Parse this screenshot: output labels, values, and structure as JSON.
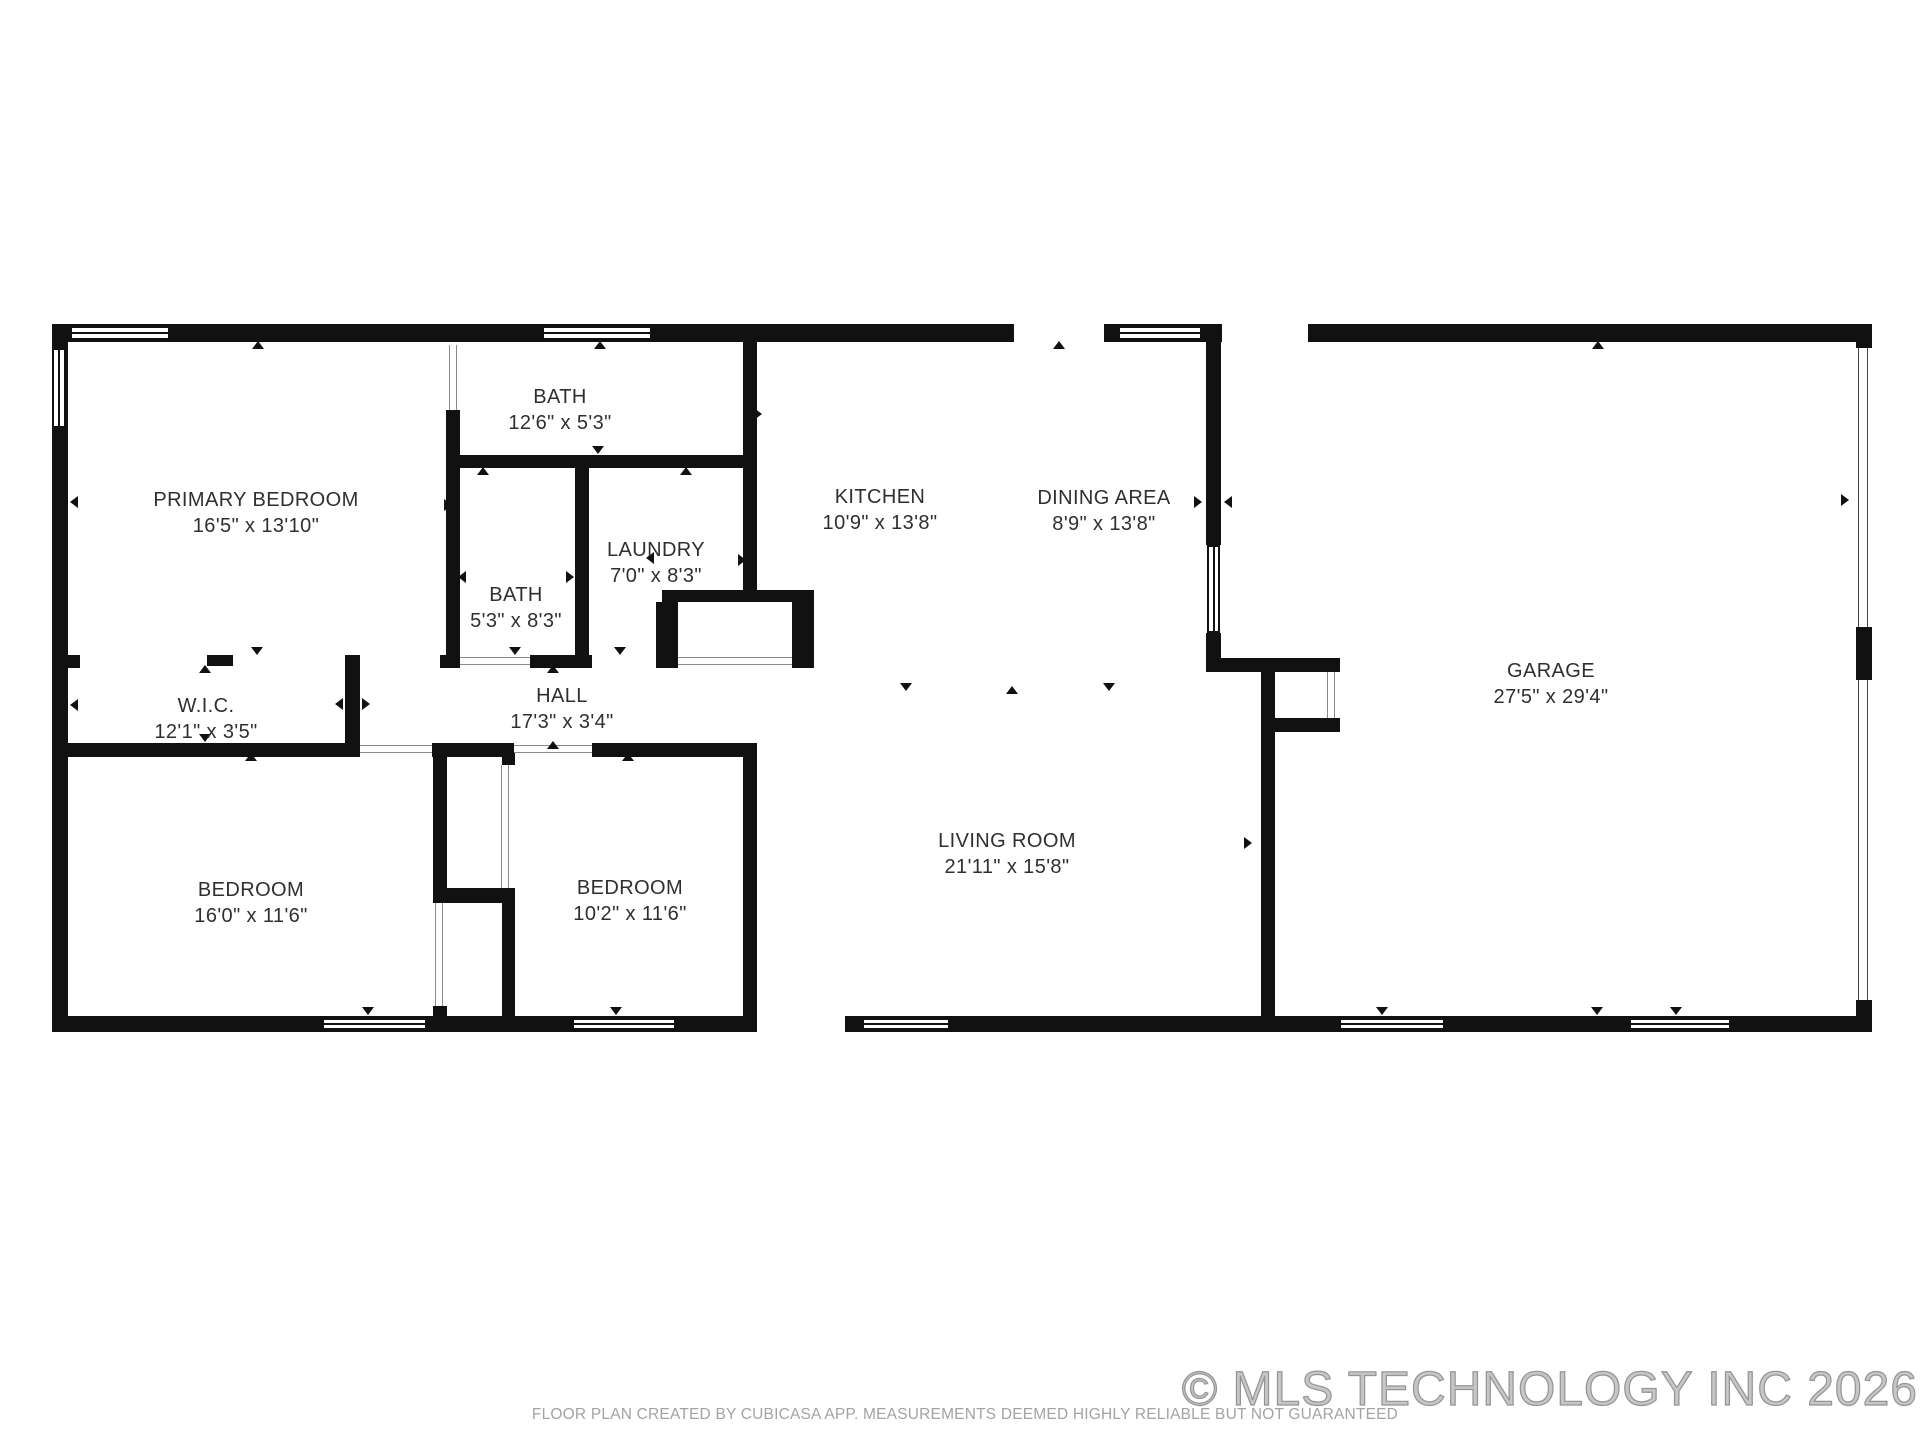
{
  "canvas": {
    "w": 1920,
    "h": 1440
  },
  "colors": {
    "wall": "#111111",
    "label": "#2f2f2f",
    "muted": "#a3a3a3",
    "watermark": "#9c9c9c"
  },
  "footer": {
    "disclaimer": "FLOOR PLAN CREATED BY CUBICASA APP. MEASUREMENTS DEEMED HIGHLY RELIABLE BUT NOT GUARANTEED",
    "copyright": "© MLS TECHNOLOGY INC 2026"
  },
  "rooms": [
    {
      "id": "primary-bedroom",
      "name": "PRIMARY BEDROOM",
      "dims": "16'5\" x 13'10\"",
      "cx": 256,
      "cy": 513
    },
    {
      "id": "bath-top",
      "name": "BATH",
      "dims": "12'6\" x 5'3\"",
      "cx": 560,
      "cy": 410
    },
    {
      "id": "kitchen",
      "name": "KITCHEN",
      "dims": "10'9\" x 13'8\"",
      "cx": 880,
      "cy": 510
    },
    {
      "id": "dining-area",
      "name": "DINING AREA",
      "dims": "8'9\" x 13'8\"",
      "cx": 1104,
      "cy": 511
    },
    {
      "id": "laundry",
      "name": "LAUNDRY",
      "dims": "7'0\" x 8'3\"",
      "cx": 656,
      "cy": 563
    },
    {
      "id": "bath-small",
      "name": "BATH",
      "dims": "5'3\" x 8'3\"",
      "cx": 516,
      "cy": 608
    },
    {
      "id": "wic",
      "name": "W.I.C.",
      "dims": "12'1\" x 3'5\"",
      "cx": 206,
      "cy": 719
    },
    {
      "id": "hall",
      "name": "HALL",
      "dims": "17'3\" x 3'4\"",
      "cx": 562,
      "cy": 709
    },
    {
      "id": "garage",
      "name": "GARAGE",
      "dims": "27'5\" x 29'4\"",
      "cx": 1551,
      "cy": 684
    },
    {
      "id": "bedroom-left",
      "name": "BEDROOM",
      "dims": "16'0\" x 11'6\"",
      "cx": 251,
      "cy": 903
    },
    {
      "id": "bedroom-right",
      "name": "BEDROOM",
      "dims": "10'2\" x 11'6\"",
      "cx": 630,
      "cy": 901
    },
    {
      "id": "living-room",
      "name": "LIVING ROOM",
      "dims": "21'11\" x 15'8\"",
      "cx": 1007,
      "cy": 854
    }
  ],
  "walls": [
    [
      52,
      324,
      962,
      18
    ],
    [
      1104,
      324,
      118,
      18
    ],
    [
      1308,
      324,
      564,
      18
    ],
    [
      52,
      324,
      16,
      708
    ],
    [
      52,
      1016,
      705,
      16
    ],
    [
      743,
      745,
      14,
      287
    ],
    [
      68,
      743,
      292,
      14
    ],
    [
      432,
      743,
      82,
      14
    ],
    [
      592,
      743,
      165,
      14
    ],
    [
      52,
      655,
      28,
      13
    ],
    [
      207,
      655,
      26,
      11
    ],
    [
      345,
      655,
      15,
      102
    ],
    [
      446,
      410,
      14,
      258
    ],
    [
      446,
      455,
      311,
      13
    ],
    [
      575,
      468,
      14,
      200
    ],
    [
      440,
      655,
      20,
      13
    ],
    [
      530,
      655,
      62,
      13
    ],
    [
      662,
      590,
      152,
      12
    ],
    [
      656,
      602,
      22,
      66
    ],
    [
      792,
      602,
      22,
      66
    ],
    [
      743,
      342,
      14,
      260
    ],
    [
      433,
      757,
      14,
      138
    ],
    [
      433,
      888,
      82,
      15
    ],
    [
      502,
      903,
      13,
      113
    ],
    [
      502,
      745,
      13,
      20
    ],
    [
      433,
      1006,
      14,
      10
    ],
    [
      845,
      1016,
      1027,
      16
    ],
    [
      1261,
      660,
      14,
      356
    ],
    [
      1206,
      658,
      134,
      14
    ],
    [
      1274,
      718,
      66,
      14
    ],
    [
      1206,
      342,
      15,
      203
    ],
    [
      1206,
      633,
      15,
      25
    ],
    [
      1856,
      324,
      16,
      24
    ],
    [
      1856,
      627,
      16,
      53
    ],
    [
      1856,
      1000,
      16,
      16
    ]
  ],
  "windows": [
    {
      "x": 70,
      "y": 326,
      "w": 100,
      "h": 14,
      "o": "h"
    },
    {
      "x": 542,
      "y": 326,
      "w": 110,
      "h": 14,
      "o": "h"
    },
    {
      "x": 1118,
      "y": 326,
      "w": 84,
      "h": 14,
      "o": "h"
    },
    {
      "x": 322,
      "y": 1018,
      "w": 105,
      "h": 12,
      "o": "h"
    },
    {
      "x": 572,
      "y": 1018,
      "w": 104,
      "h": 12,
      "o": "h"
    },
    {
      "x": 862,
      "y": 1018,
      "w": 88,
      "h": 12,
      "o": "h"
    },
    {
      "x": 1339,
      "y": 1018,
      "w": 106,
      "h": 12,
      "o": "h"
    },
    {
      "x": 1629,
      "y": 1018,
      "w": 102,
      "h": 12,
      "o": "h"
    },
    {
      "x": 52,
      "y": 348,
      "w": 14,
      "h": 80,
      "o": "v"
    },
    {
      "x": 1207,
      "y": 545,
      "w": 13,
      "h": 88,
      "o": "v"
    }
  ],
  "doors": [
    {
      "x": 360,
      "y": 745,
      "w": 72,
      "h": 8,
      "o": "h",
      "kind": "door"
    },
    {
      "x": 514,
      "y": 745,
      "w": 78,
      "h": 8,
      "o": "h",
      "kind": "door"
    },
    {
      "x": 460,
      "y": 657,
      "w": 70,
      "h": 8,
      "o": "h",
      "kind": "door"
    },
    {
      "x": 678,
      "y": 657,
      "w": 114,
      "h": 8,
      "o": "h",
      "kind": "door"
    },
    {
      "x": 449,
      "y": 345,
      "w": 8,
      "h": 65,
      "o": "v",
      "kind": "door"
    },
    {
      "x": 501,
      "y": 765,
      "w": 8,
      "h": 123,
      "o": "v",
      "kind": "door"
    },
    {
      "x": 435,
      "y": 903,
      "w": 8,
      "h": 103,
      "o": "v",
      "kind": "door"
    },
    {
      "x": 1327,
      "y": 672,
      "w": 8,
      "h": 46,
      "o": "v",
      "kind": "door"
    },
    {
      "x": 1858,
      "y": 348,
      "w": 10,
      "h": 279,
      "o": "v",
      "kind": "garage-door"
    },
    {
      "x": 1858,
      "y": 680,
      "w": 10,
      "h": 320,
      "o": "v",
      "kind": "garage-door"
    }
  ],
  "arrows": [
    {
      "x": 258,
      "y": 345,
      "dir": "up"
    },
    {
      "x": 600,
      "y": 345,
      "dir": "up"
    },
    {
      "x": 1059,
      "y": 345,
      "dir": "up"
    },
    {
      "x": 1598,
      "y": 345,
      "dir": "up"
    },
    {
      "x": 553,
      "y": 745,
      "dir": "up"
    },
    {
      "x": 628,
      "y": 757,
      "dir": "up"
    },
    {
      "x": 205,
      "y": 669,
      "dir": "up"
    },
    {
      "x": 251,
      "y": 757,
      "dir": "up"
    },
    {
      "x": 483,
      "y": 471,
      "dir": "up"
    },
    {
      "x": 686,
      "y": 471,
      "dir": "up"
    },
    {
      "x": 553,
      "y": 669,
      "dir": "up"
    },
    {
      "x": 1012,
      "y": 690,
      "dir": "up"
    },
    {
      "x": 598,
      "y": 450,
      "dir": "down"
    },
    {
      "x": 515,
      "y": 651,
      "dir": "down"
    },
    {
      "x": 620,
      "y": 651,
      "dir": "down"
    },
    {
      "x": 257,
      "y": 651,
      "dir": "down"
    },
    {
      "x": 205,
      "y": 738,
      "dir": "down"
    },
    {
      "x": 906,
      "y": 687,
      "dir": "down"
    },
    {
      "x": 1109,
      "y": 687,
      "dir": "down"
    },
    {
      "x": 1597,
      "y": 1011,
      "dir": "down"
    },
    {
      "x": 368,
      "y": 1011,
      "dir": "down"
    },
    {
      "x": 616,
      "y": 1011,
      "dir": "down"
    },
    {
      "x": 1382,
      "y": 1011,
      "dir": "down"
    },
    {
      "x": 1676,
      "y": 1011,
      "dir": "down"
    },
    {
      "x": 74,
      "y": 502,
      "dir": "left"
    },
    {
      "x": 74,
      "y": 705,
      "dir": "left"
    },
    {
      "x": 462,
      "y": 577,
      "dir": "left"
    },
    {
      "x": 650,
      "y": 558,
      "dir": "left"
    },
    {
      "x": 339,
      "y": 704,
      "dir": "left"
    },
    {
      "x": 1228,
      "y": 502,
      "dir": "left"
    },
    {
      "x": 448,
      "y": 505,
      "dir": "right"
    },
    {
      "x": 742,
      "y": 560,
      "dir": "right"
    },
    {
      "x": 366,
      "y": 704,
      "dir": "right"
    },
    {
      "x": 1198,
      "y": 502,
      "dir": "right"
    },
    {
      "x": 1248,
      "y": 843,
      "dir": "right"
    },
    {
      "x": 1845,
      "y": 500,
      "dir": "right"
    },
    {
      "x": 758,
      "y": 414,
      "dir": "right"
    },
    {
      "x": 570,
      "y": 577,
      "dir": "right"
    }
  ]
}
